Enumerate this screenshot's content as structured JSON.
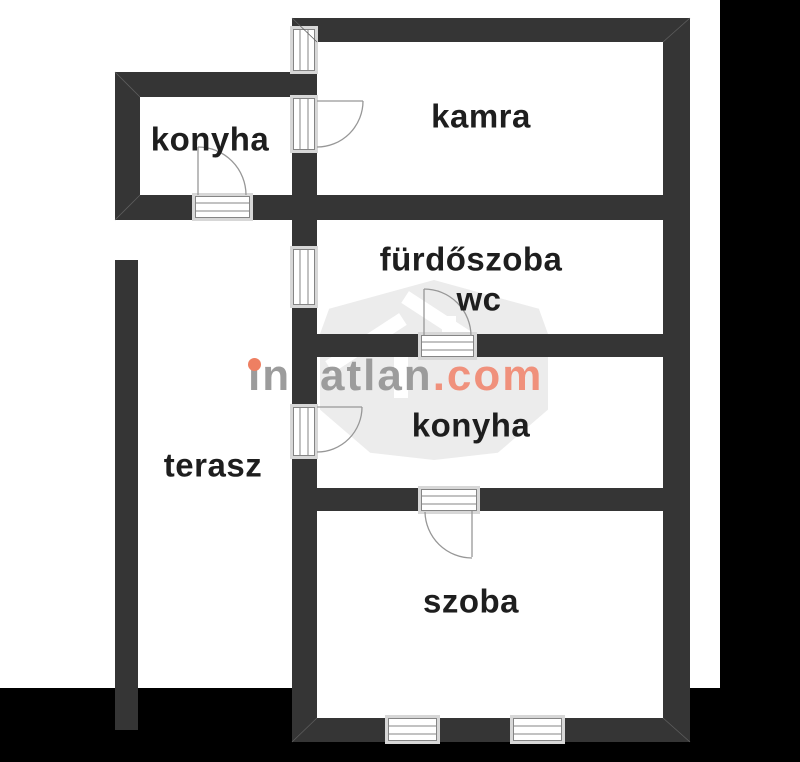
{
  "page": {
    "type": "floor-plan"
  },
  "colors": {
    "wall": "#353535",
    "matte": "#000000",
    "canvas": "#ffffff",
    "label": "#1e1e1e",
    "door_line": "#979797",
    "opening_frame": "#d7d7d7",
    "opening_line": "#858585",
    "watermark_shield": "#ececec"
  },
  "rooms": [
    {
      "id": "konyha-annex",
      "label": "konyha"
    },
    {
      "id": "kamra",
      "label": "kamra"
    },
    {
      "id": "furdoszoba",
      "label": "fürdőszoba"
    },
    {
      "id": "wc",
      "label": "wc"
    },
    {
      "id": "konyha",
      "label": "konyha"
    },
    {
      "id": "terasz",
      "label": "terasz"
    },
    {
      "id": "szoba",
      "label": "szoba"
    }
  ],
  "watermark": {
    "brand": "ingatlan",
    "tld": ".com",
    "brand_color": "#9c9c9c",
    "tld_color": "#f0917c",
    "dot_color": "#ee7f62"
  }
}
